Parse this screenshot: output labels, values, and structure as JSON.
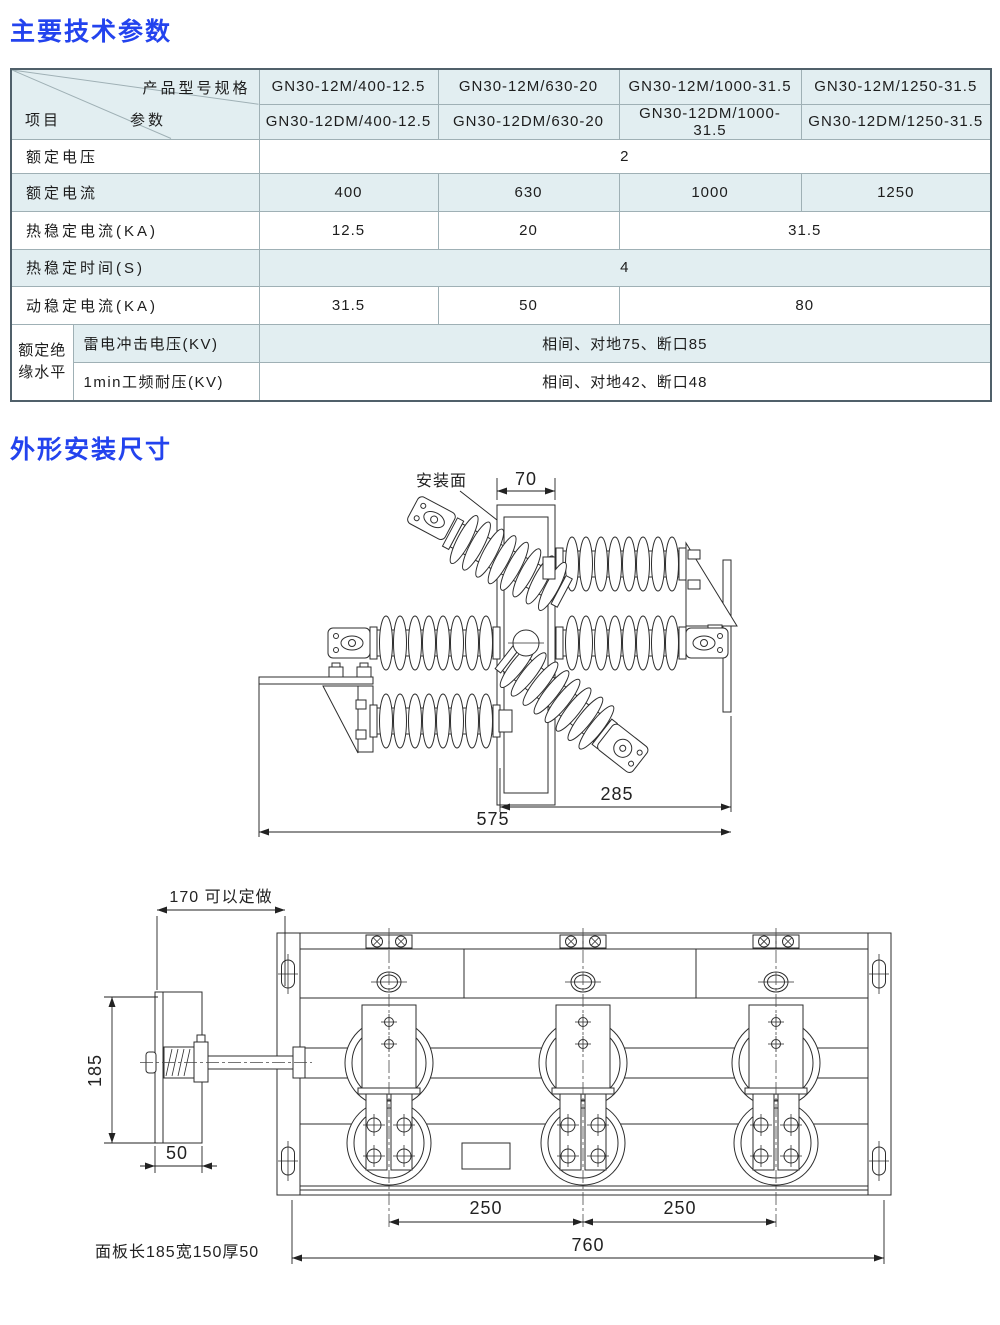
{
  "titles": {
    "params": "主要技术参数",
    "outline": "外形安装尺寸"
  },
  "colors": {
    "accent": "#2343ee",
    "table_tint": "#e2eef1"
  },
  "table": {
    "corner": {
      "top": "产品型号规格",
      "middle": "参数",
      "left": "项目"
    },
    "models": [
      [
        "GN30-12M/400-12.5",
        "GN30-12M/630-20",
        "GN30-12M/1000-31.5",
        "GN30-12M/1250-31.5"
      ],
      [
        "GN30-12DM/400-12.5",
        "GN30-12DM/630-20",
        "GN30-12DM/1000-31.5",
        "GN30-12DM/1250-31.5"
      ]
    ],
    "rows": [
      {
        "label": "额定电压",
        "cells": [
          {
            "text": "2"
          }
        ]
      },
      {
        "label": "额定电流",
        "cells": [
          {
            "text": "400"
          },
          {
            "text": "630"
          },
          {
            "text": "1000"
          },
          {
            "text": "1250"
          }
        ]
      },
      {
        "label": "热稳定电流(KA)",
        "cells": [
          {
            "text": "12.5"
          },
          {
            "text": "20"
          },
          {
            "text": "31.5"
          }
        ]
      },
      {
        "label": "热稳定时间(S)",
        "cells": [
          {
            "text": "4"
          }
        ]
      },
      {
        "label": "动稳定电流(KA)",
        "cells": [
          {
            "text": "31.5"
          },
          {
            "text": "50"
          },
          {
            "text": "80"
          }
        ]
      },
      {
        "group": "额定绝缘水平",
        "label": "雷电冲击电压(KV)",
        "cells": [
          {
            "text": "相间、对地75、断口85"
          }
        ]
      },
      {
        "label": "1min工频耐压(KV)",
        "cells": [
          {
            "text": "相间、对地42、断口48"
          }
        ]
      }
    ]
  },
  "drawing_side": {
    "mounting_face": "安装面",
    "dim_70": "70",
    "dim_285": "285",
    "dim_575": "575"
  },
  "drawing_front": {
    "dim_170": "170 可以定做",
    "dim_185": "185",
    "dim_50": "50",
    "dim_250_left": "250",
    "dim_250_right": "250",
    "dim_760": "760",
    "caption": "面板长185宽150厚50"
  }
}
